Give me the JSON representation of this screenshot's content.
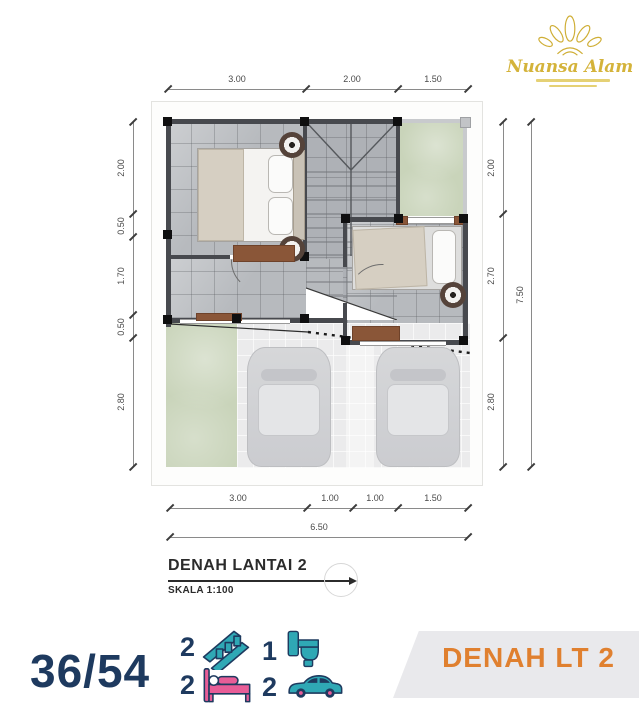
{
  "logo": {
    "name": "Nuansa Alam"
  },
  "plan": {
    "dims": {
      "top": [
        "3.00",
        "2.00",
        "1.50"
      ],
      "left": [
        "2.00",
        "0.50",
        "1.70",
        "0.50",
        "2.80"
      ],
      "right": [
        "2.00",
        "2.70",
        "2.80"
      ],
      "right_total": "7.50",
      "bottom": [
        "3.00",
        "1.00",
        "1.00",
        "1.50"
      ],
      "bottom_total": "6.50"
    }
  },
  "title_block": {
    "title": "DENAH LANTAI 2",
    "scale": "SKALA 1:100"
  },
  "footer": {
    "type_label": "36/54",
    "specs": [
      {
        "count": "2",
        "icon": "stairs-icon"
      },
      {
        "count": "1",
        "icon": "toilet-icon"
      },
      {
        "count": "2",
        "icon": "bed-icon"
      },
      {
        "count": "2",
        "icon": "car-icon"
      }
    ],
    "banner_label": "DENAH LT 2"
  },
  "colors": {
    "navy": "#1e3a5f",
    "teal": "#2fa8b5",
    "pink": "#e85d97",
    "orange": "#e0802f",
    "gold": "#cfae35",
    "banner_gray": "#e9e9ec"
  }
}
